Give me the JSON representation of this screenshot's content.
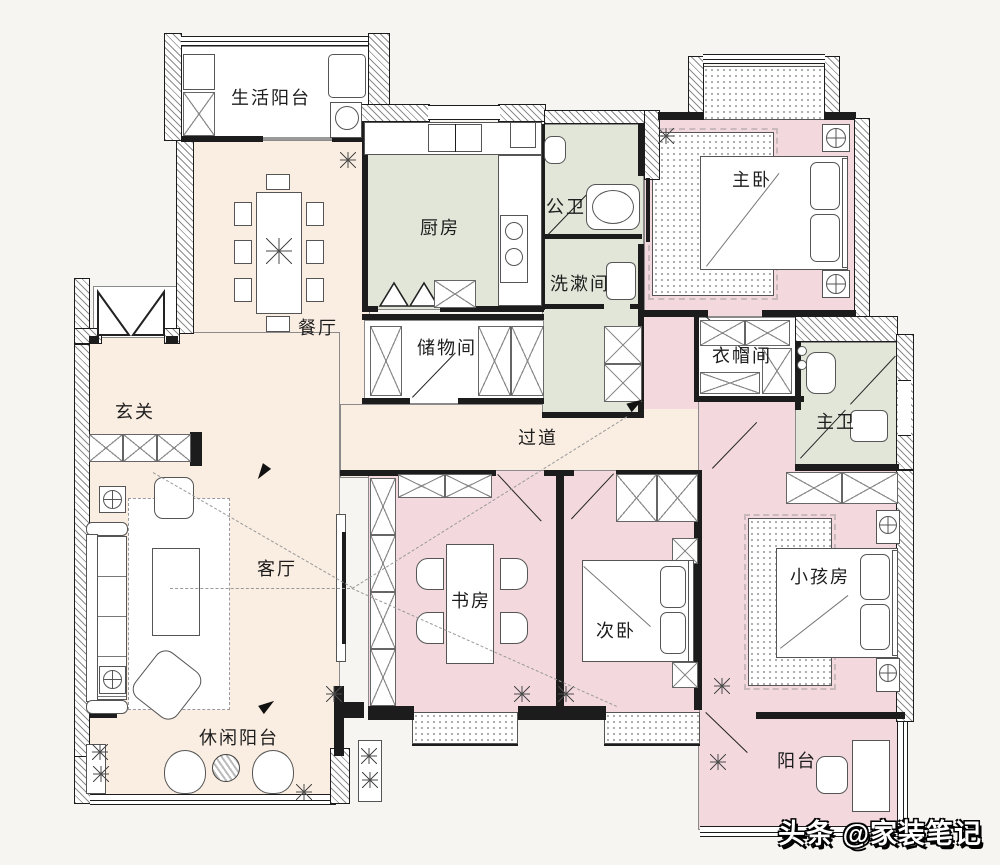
{
  "palette": {
    "bg": "#f7f5f1",
    "cream": "#faede1",
    "pink": "#f3d9de",
    "green": "#e1e6d8",
    "wall": "#1c1c1c"
  },
  "rooms": {
    "service_balcony": "生活阳台",
    "dining": "餐厅",
    "kitchen": "厨房",
    "public_bath": "公卫",
    "washroom": "洗漱间",
    "master_bedroom": "主卧",
    "storage": "储物间",
    "cloakroom": "衣帽间",
    "master_bath": "主卫",
    "entry": "玄关",
    "corridor": "过道",
    "living": "客厅",
    "study": "书房",
    "second_bedroom": "次卧",
    "kids_room": "小孩房",
    "leisure_balcony": "休闲阳台",
    "balcony": "阳台"
  },
  "watermark": "头条 @家装笔记"
}
